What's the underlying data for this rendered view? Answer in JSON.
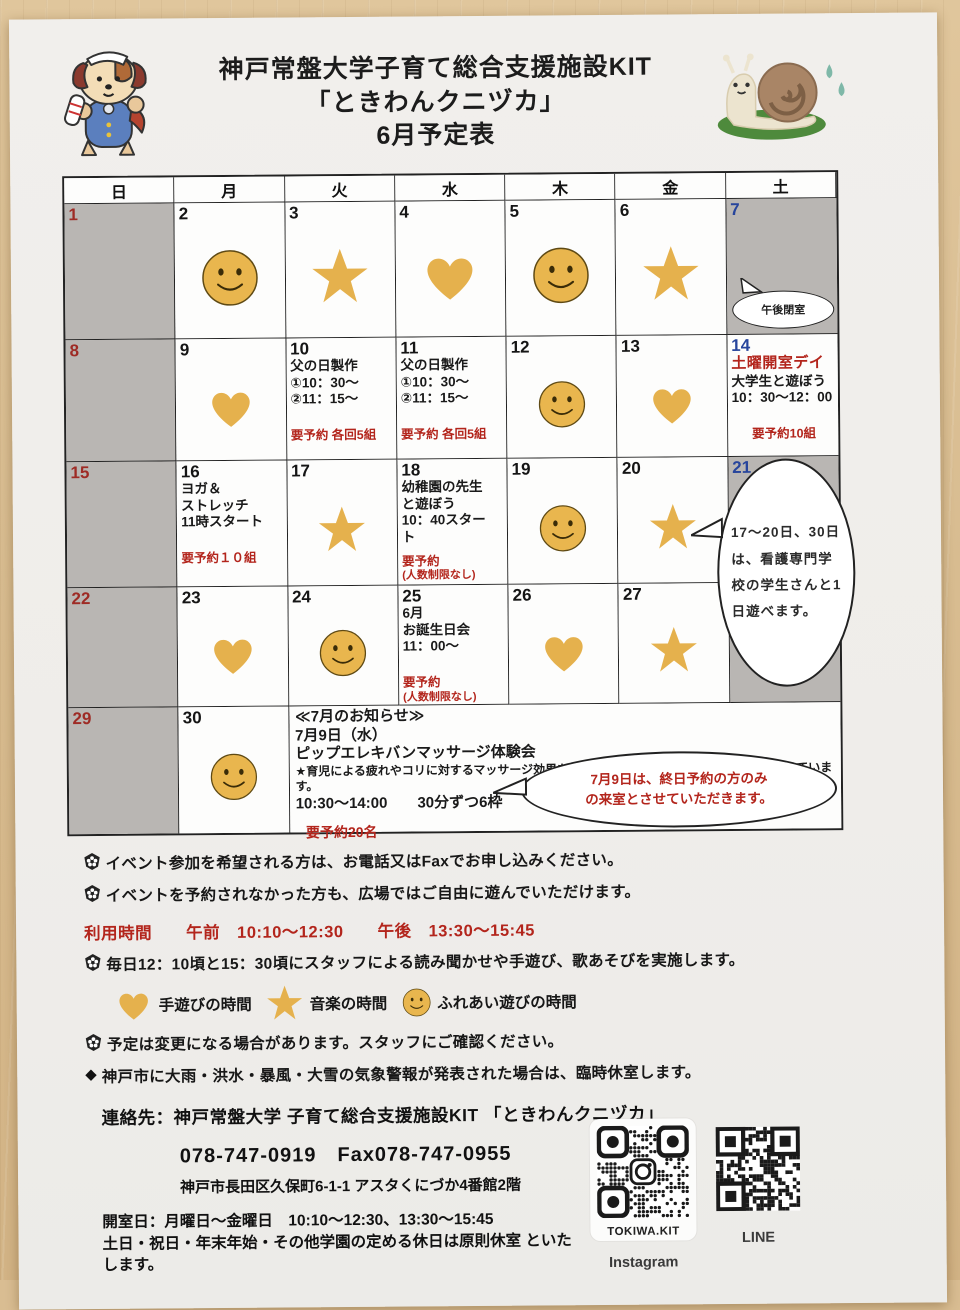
{
  "page": {
    "title_line1": "神戸常盤大学子育て総合支援施設KIT",
    "title_line2": "「ときわんクニヅカ」",
    "title_line3": "6月予定表"
  },
  "colors": {
    "sunday_red": "#9e2b25",
    "saturday_blue": "#27459c",
    "event_red": "#b3251c",
    "icon_gold": "#e5b14d",
    "cell_gray": "#b9b6b3"
  },
  "weekday_header": [
    "日",
    "月",
    "火",
    "水",
    "木",
    "金",
    "土"
  ],
  "weeks": [
    [
      {
        "day": "1",
        "dow": "sun",
        "shaded": true
      },
      {
        "day": "2",
        "icon": "smiley"
      },
      {
        "day": "3",
        "icon": "star"
      },
      {
        "day": "4",
        "icon": "heart"
      },
      {
        "day": "5",
        "icon": "smiley"
      },
      {
        "day": "6",
        "icon": "star"
      },
      {
        "day": "7",
        "dow": "sat",
        "shaded": true,
        "bubble": "afternoon"
      }
    ],
    [
      {
        "day": "8",
        "dow": "sun",
        "shaded": true
      },
      {
        "day": "9",
        "icon": "heart"
      },
      {
        "day": "10",
        "lines": [
          {
            "t": "父の日製作"
          },
          {
            "t": "①10：30～"
          },
          {
            "t": "②11：15～"
          },
          {
            "t": "要予約 各回5組",
            "red": true,
            "gap": true
          }
        ]
      },
      {
        "day": "11",
        "lines": [
          {
            "t": "父の日製作"
          },
          {
            "t": "①10：30～"
          },
          {
            "t": "②11：15～"
          },
          {
            "t": "要予約 各回5組",
            "red": true,
            "gap": true
          }
        ]
      },
      {
        "day": "12",
        "icon": "smiley"
      },
      {
        "day": "13",
        "icon": "heart"
      },
      {
        "day": "14",
        "dow": "sat",
        "lines": [
          {
            "t": "土曜開室デイ",
            "titleRed": true
          },
          {
            "t": "大学生と遊ぼう"
          },
          {
            "t": "10：30～12：00"
          },
          {
            "t": "要予約10組",
            "red": true,
            "gap": true,
            "center": true
          }
        ]
      }
    ],
    [
      {
        "day": "15",
        "dow": "sun",
        "shaded": true
      },
      {
        "day": "16",
        "lines": [
          {
            "t": "ヨガ＆"
          },
          {
            "t": "ストレッチ"
          },
          {
            "t": "11時スタート"
          },
          {
            "t": "要予約１０組",
            "red": true,
            "gap": true
          }
        ]
      },
      {
        "day": "17",
        "icon": "star"
      },
      {
        "day": "18",
        "lines": [
          {
            "t": "幼稚園の先生"
          },
          {
            "t": "と遊ぼう"
          },
          {
            "t": "10：40スター"
          },
          {
            "t": "ト"
          },
          {
            "t": "要予約",
            "red": true,
            "gap8": true
          },
          {
            "t": "(人数制限なし)",
            "red": true,
            "small": true
          }
        ]
      },
      {
        "day": "19",
        "icon": "smiley"
      },
      {
        "day": "20",
        "icon": "star"
      },
      {
        "day": "21",
        "dow": "sat",
        "shaded": true
      }
    ],
    [
      {
        "day": "22",
        "dow": "sun",
        "shaded": true
      },
      {
        "day": "23",
        "icon": "heart"
      },
      {
        "day": "24",
        "icon": "smiley"
      },
      {
        "day": "25",
        "lines": [
          {
            "t": "6月"
          },
          {
            "t": "お誕生日会"
          },
          {
            "t": "11：00～"
          },
          {
            "t": "要予約",
            "red": true,
            "gap": true
          },
          {
            "t": "(人数制限なし)",
            "red": true,
            "small": true
          }
        ]
      },
      {
        "day": "26",
        "icon": "heart"
      },
      {
        "day": "27",
        "icon": "star"
      },
      {
        "day": "",
        "dow": "sat",
        "shaded": true
      }
    ],
    [
      {
        "day": "29",
        "dow": "sun",
        "shaded": true
      },
      {
        "day": "30",
        "icon": "smiley"
      },
      {
        "ann": true
      }
    ]
  ],
  "announcement": {
    "lines": [
      {
        "t": "≪7月のお知らせ≫"
      },
      {
        "t": "7月9日（水）"
      },
      {
        "t": "ピップエレキバンマッサージ体験会"
      },
      {
        "t": "★育児による疲れやコリに対するマッサージ効果を調査する研究にご協力いただける方を募っています。",
        "tiny": true
      },
      {
        "t": "10:30～14:00　　30分ずつ6枠"
      },
      {
        "t": "要予約20名",
        "red": true
      }
    ]
  },
  "bubbles": {
    "afternoon_closed": "午後閉室",
    "nursing": "17～20日、30日は、看護専門学校の学生さんと1日遊べます。",
    "july_line1": "7月9日は、終日予約の方のみ",
    "july_line2": "の来室とさせていただきます。"
  },
  "notes": {
    "note1": "イベント参加を希望される方は、お電話又はFaxでお申し込みください。",
    "note2": "イベントを予約されなかった方も、広場ではご自由に遊んでいただけます。",
    "usage": "利用時間　　午前　10:10～12:30　　午後　13:30～15:45",
    "note3": "毎日12：10頃と15：30頃にスタッフによる読み聞かせや手遊び、歌あそびを実施します。",
    "note4": "予定は変更になる場合があります。スタッフにご確認ください。",
    "note5": "神戸市に大雨・洪水・暴風・大雪の気象警報が発表された場合は、臨時休室します。"
  },
  "legend": [
    {
      "icon": "heart-icon",
      "label": "手遊びの時間"
    },
    {
      "icon": "star-icon",
      "label": "音楽の時間"
    },
    {
      "icon": "smiley-icon",
      "label": "ふれあい遊びの時間"
    }
  ],
  "contact": {
    "line1": "連絡先：神戸常盤大学 子育て総合支援施設KIT 「ときわんクニヅカ」",
    "line2": "078-747-0919　Fax078-747-0955",
    "line3": "神戸市長田区久保町6-1-1 アスタくにづか4番館2階",
    "line4": "開室日：月曜日～金曜日　10:10～12:30、13:30～15:45",
    "line5": "土日・祝日・年末年始・その他学園の定める休日は原則休室 といたします。"
  },
  "qr": {
    "instagram_account": "TOKIWA.KIT",
    "instagram_label": "Instagram",
    "line_label": "LINE"
  }
}
